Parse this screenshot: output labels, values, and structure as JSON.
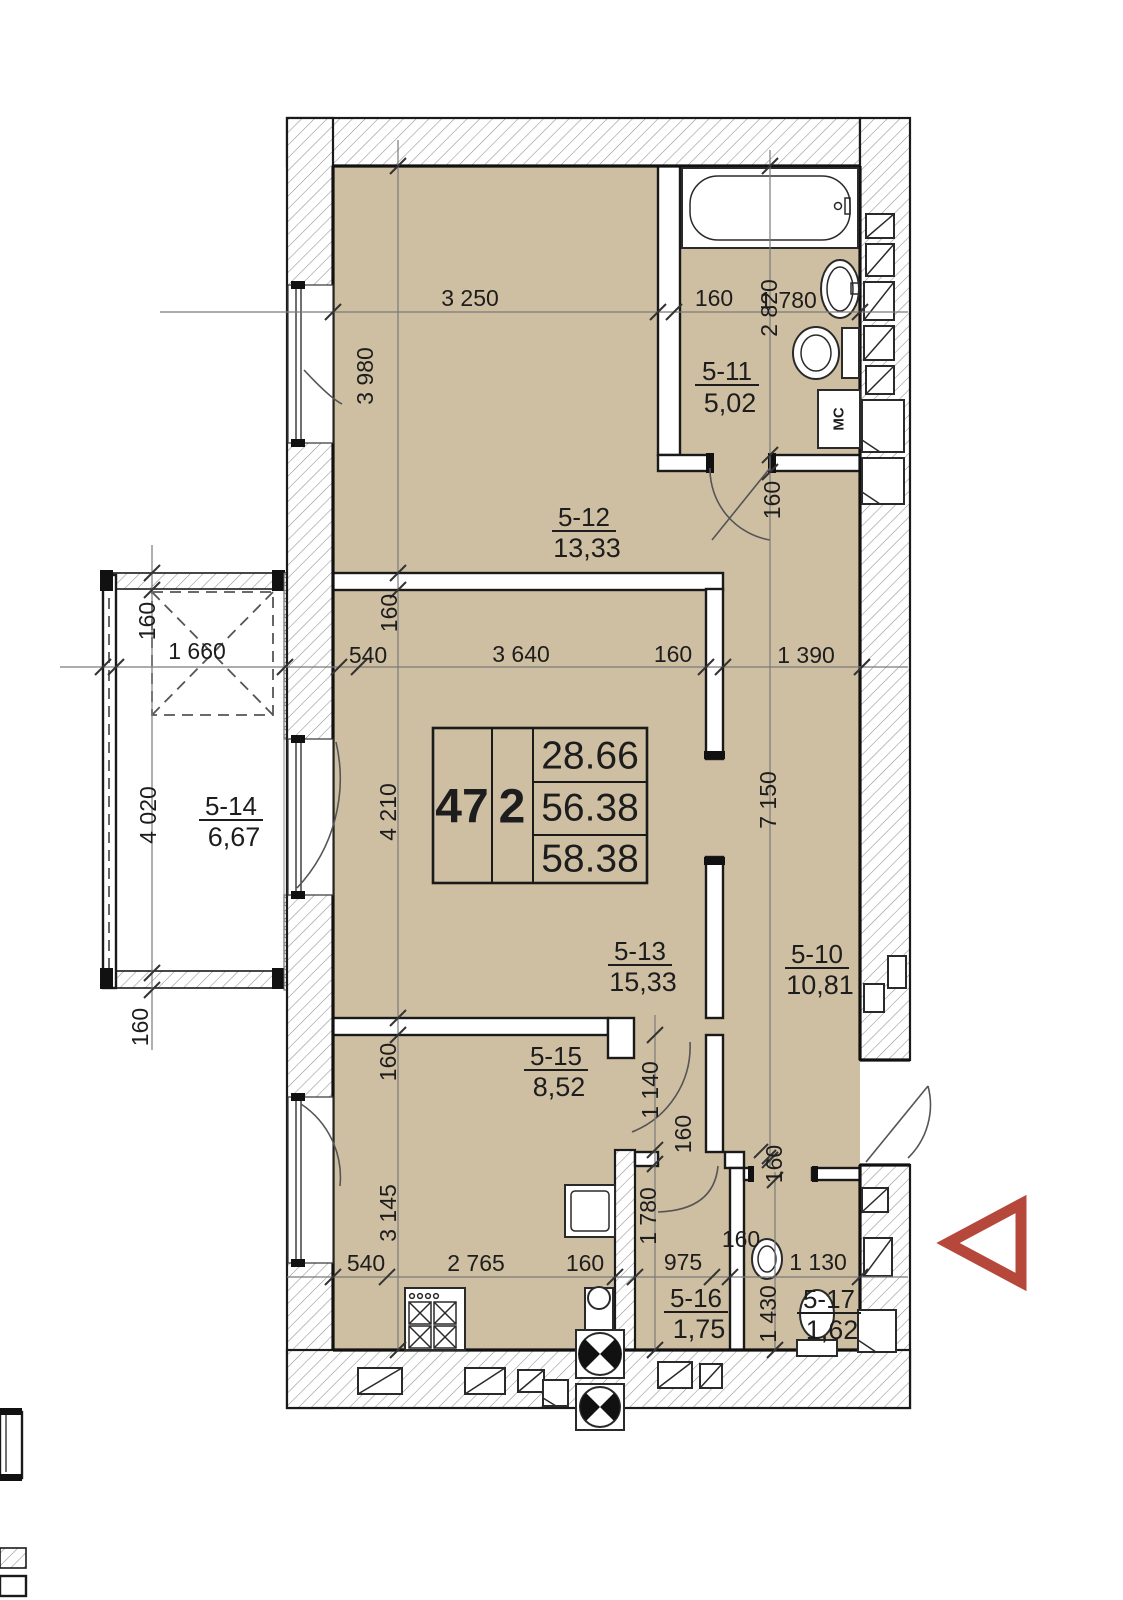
{
  "unit": {
    "number": "47",
    "room_count": "2",
    "area_living": "28.66",
    "area_apartment": "56.38",
    "area_total": "58.38"
  },
  "rooms": [
    {
      "id": "5-11",
      "area": "5,02"
    },
    {
      "id": "5-12",
      "area": "13,33"
    },
    {
      "id": "5-13",
      "area": "15,33"
    },
    {
      "id": "5-14",
      "area": "6,67"
    },
    {
      "id": "5-15",
      "area": "8,52"
    },
    {
      "id": "5-16",
      "area": "1,75"
    },
    {
      "id": "5-17",
      "area": "1,62"
    },
    {
      "id": "5-10",
      "area": "10,81"
    }
  ],
  "labels": {
    "washing_machine": "МС"
  },
  "dims": {
    "d01": "3 250",
    "d02": "160",
    "d03": "1 780",
    "d04": "3 980",
    "d05": "2 820",
    "d06": "160",
    "d07": "160",
    "d08": "1 660",
    "d09": "540",
    "d10": "160",
    "d11": "3 640",
    "d12": "160",
    "d13": "1 390",
    "d14": "4 020",
    "d15": "4 210",
    "d16": "7 150",
    "d17": "160",
    "d18": "160",
    "d19": "1 140",
    "d20": "160",
    "d21": "160",
    "d22": "540",
    "d23": "2 765",
    "d24": "160",
    "d25": "975",
    "d26": "160",
    "d27": "1 130",
    "d28": "3 145",
    "d29": "1 780",
    "d30": "1 430"
  },
  "colors": {
    "floor_fill": "#cfbfa2",
    "wall_line": "#1a1a1a",
    "entry_arrow": "#b5483b"
  }
}
